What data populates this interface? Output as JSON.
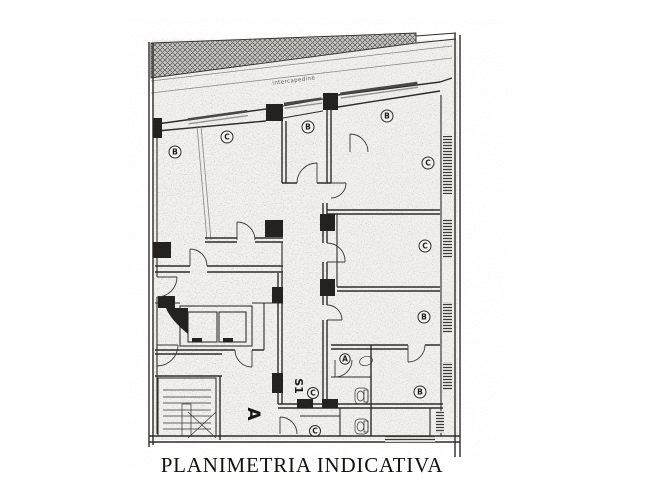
{
  "title": "PLANIMETRIA INDICATIVA",
  "plan": {
    "strip_label": "intercapedine",
    "zone_labels": {
      "hall": "A",
      "stairwell": "S1"
    },
    "room_labels": [
      {
        "letter": "B"
      },
      {
        "letter": "C"
      },
      {
        "letter": "B"
      },
      {
        "letter": "B"
      },
      {
        "letter": "C"
      },
      {
        "letter": "C"
      },
      {
        "letter": "B"
      },
      {
        "letter": "A"
      },
      {
        "letter": "B"
      },
      {
        "letter": "C"
      },
      {
        "letter": "C"
      }
    ]
  },
  "colors": {
    "ink": "#2e2c2a",
    "paper": "#ffffff",
    "scan_tint": "#e7e5e0"
  }
}
